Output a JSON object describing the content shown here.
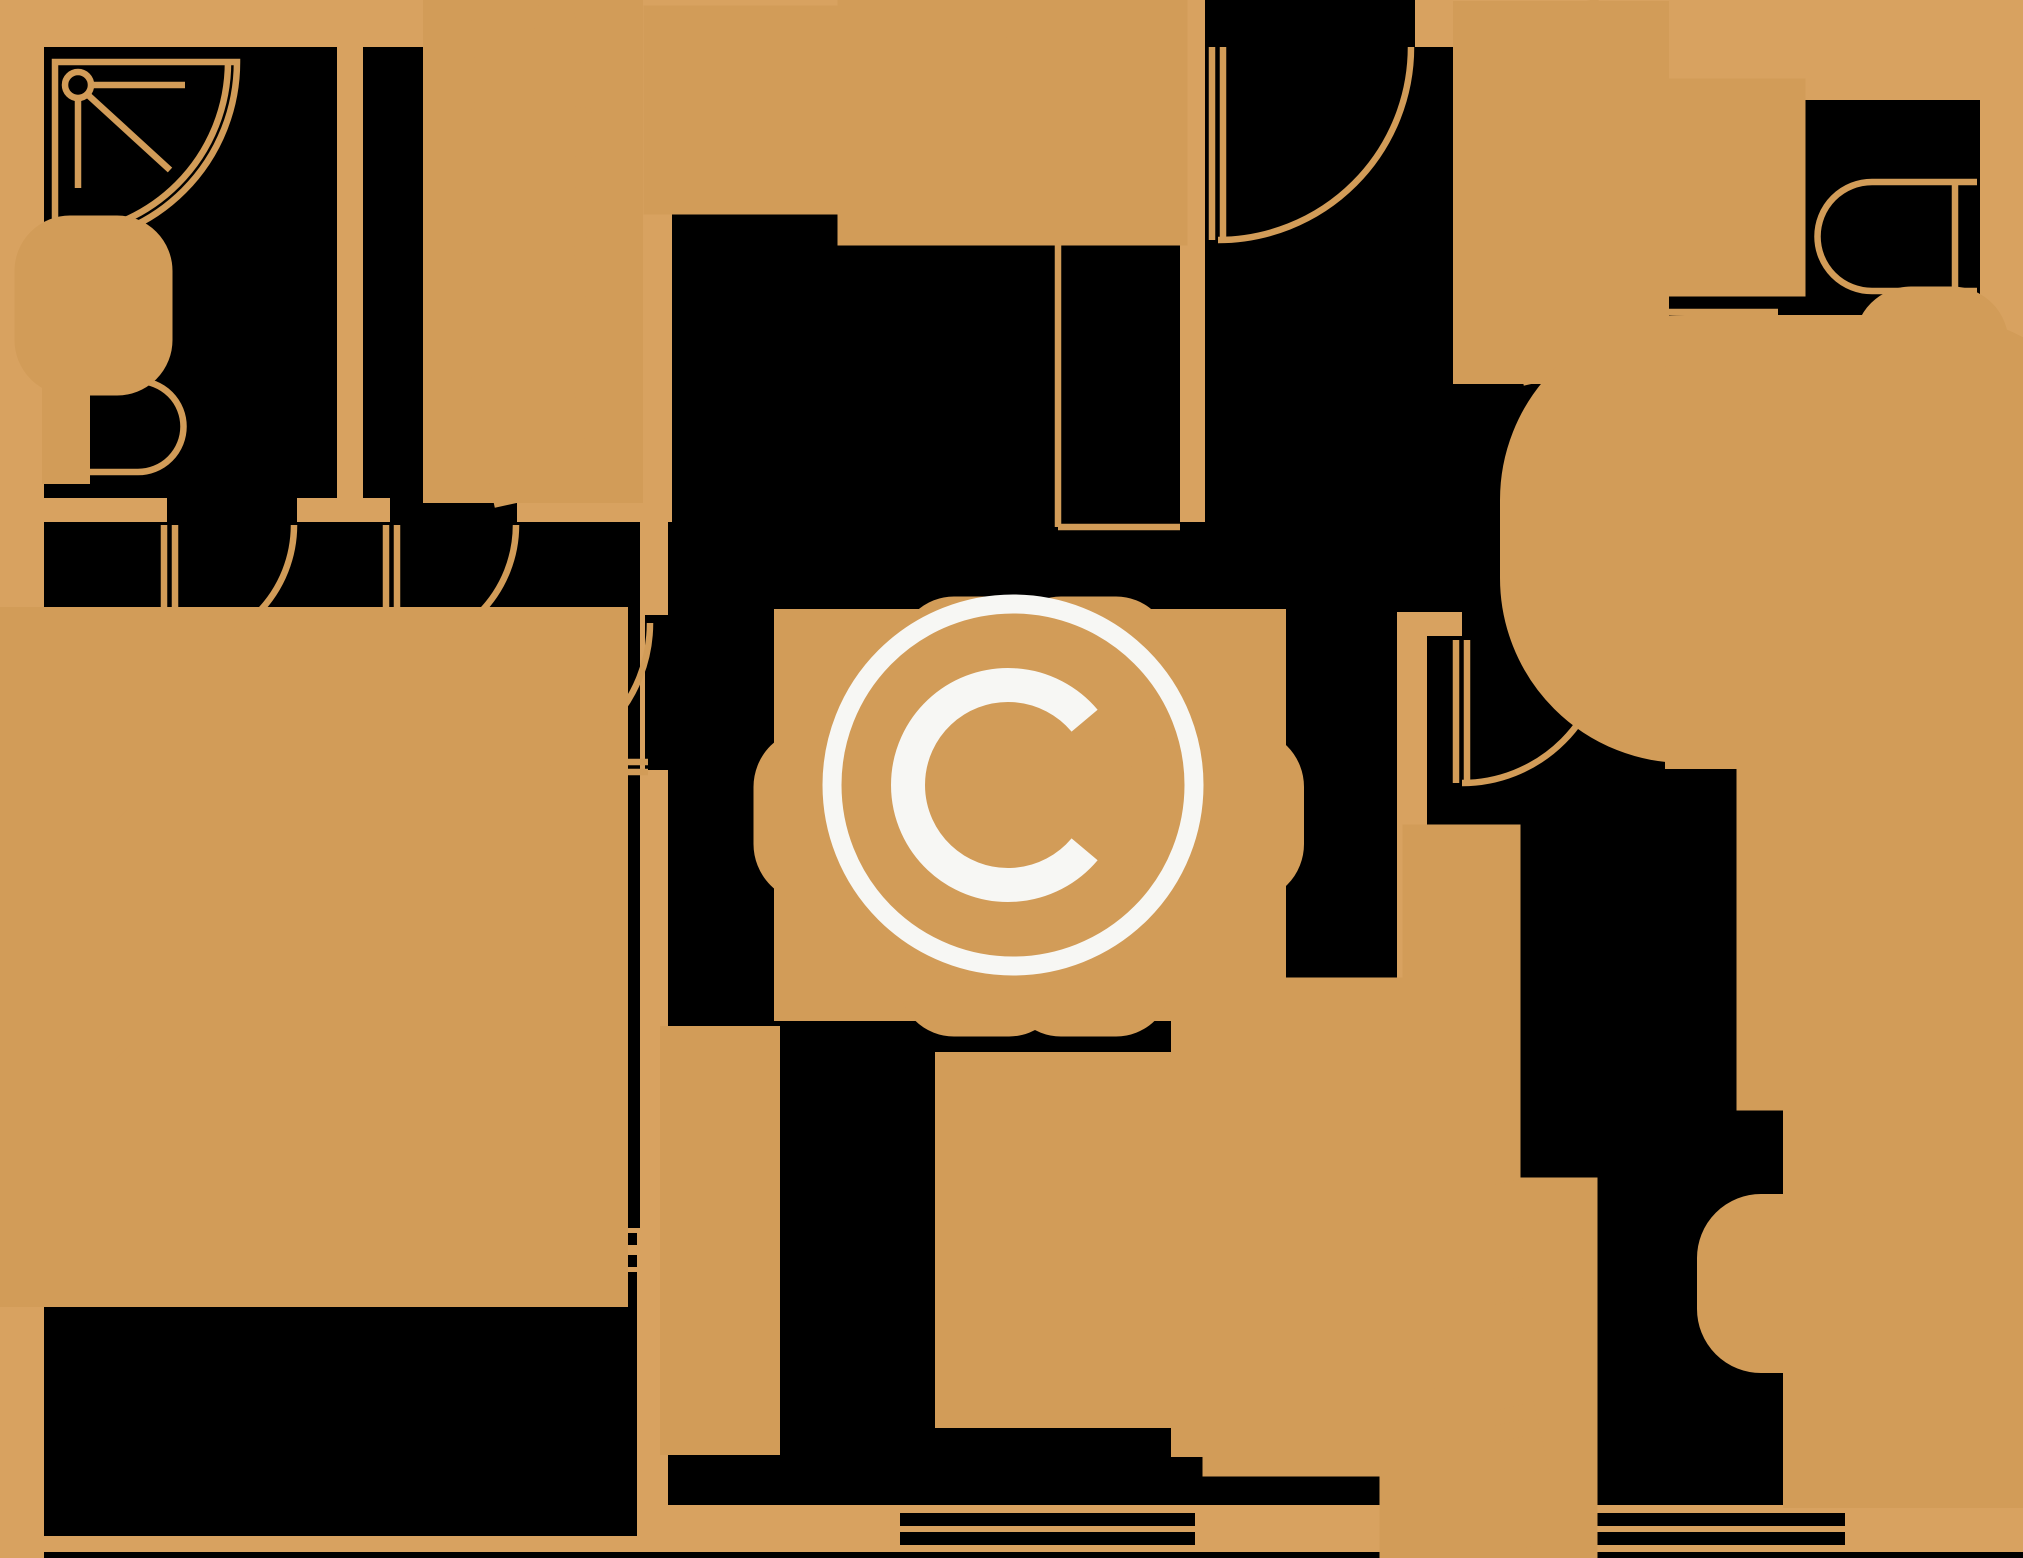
{
  "canvas": {
    "w": 2023,
    "h": 1558
  },
  "palette": {
    "wall": "#D8A260",
    "room": "#000000",
    "line": "#D29C58",
    "mark": "#F7F7F4"
  },
  "watermark": {
    "glyph": "copyright-symbol",
    "cx": 1013,
    "cy": 785,
    "ring_r": 181,
    "ring_w": 19,
    "c_path": "M1084.6,720.7 A100,100 0 1 0 1084.6,849.3",
    "c_w": 34
  },
  "rooms": [
    {
      "n": "room-bathroom-topleft",
      "x": 44,
      "y": 47,
      "w": 293,
      "h": 451
    },
    {
      "n": "room-closet-topleft",
      "x": 363,
      "y": 47,
      "w": 227,
      "h": 451
    },
    {
      "n": "room-kitchen",
      "x": 672,
      "y": 47,
      "w": 508,
      "h": 480
    },
    {
      "n": "room-hall",
      "x": 1205,
      "y": 47,
      "w": 412,
      "h": 565
    },
    {
      "n": "entry-opening",
      "x": 1205,
      "y": 0,
      "w": 210,
      "h": 47
    },
    {
      "n": "room-bathroom-topright",
      "x": 1643,
      "y": 100,
      "w": 337,
      "h": 508
    },
    {
      "n": "doorway-bathroom-topright",
      "x": 1617,
      "y": 317,
      "w": 26,
      "h": 140
    },
    {
      "n": "room-bedroom-right",
      "x": 1427,
      "y": 636,
      "w": 553,
      "h": 869
    },
    {
      "n": "doorway-bedroom-right",
      "x": 1462,
      "y": 608,
      "w": 145,
      "h": 30
    },
    {
      "n": "room-living-dining",
      "x": 668,
      "y": 522,
      "w": 729,
      "h": 983
    },
    {
      "n": "room-bedroom-left",
      "x": 44,
      "y": 522,
      "w": 596,
      "h": 706
    },
    {
      "n": "doorway-bathroom-topleft",
      "x": 167,
      "y": 498,
      "w": 130,
      "h": 24
    },
    {
      "n": "doorway-closet",
      "x": 390,
      "y": 498,
      "w": 127,
      "h": 24
    },
    {
      "n": "doorway-living",
      "x": 645,
      "y": 615,
      "w": 25,
      "h": 155
    },
    {
      "n": "room-balcony",
      "x": 44,
      "y": 1272,
      "w": 593,
      "h": 264
    },
    {
      "n": "plan-bottom-edge",
      "x": 44,
      "y": 1552,
      "w": 1979,
      "h": 6
    },
    {
      "n": "window-bedroom-left-1",
      "x": 247,
      "y": 1233,
      "w": 390,
      "h": 12
    },
    {
      "n": "window-bedroom-left-2",
      "x": 247,
      "y": 1255,
      "w": 390,
      "h": 12
    },
    {
      "n": "window-living-1",
      "x": 900,
      "y": 1513,
      "w": 295,
      "h": 13
    },
    {
      "n": "window-living-2",
      "x": 900,
      "y": 1532,
      "w": 295,
      "h": 13
    },
    {
      "n": "window-bedroom-right-1",
      "x": 1554,
      "y": 1513,
      "w": 291,
      "h": 13
    },
    {
      "n": "window-bedroom-right-2",
      "x": 1554,
      "y": 1532,
      "w": 291,
      "h": 13
    }
  ],
  "shapes": [
    {
      "n": "shower-outline",
      "t": "path",
      "d": "M55,62 H237 A182,182 0 0 1 55,244 Z"
    },
    {
      "n": "shower-inner-arc",
      "t": "path",
      "d": "M228,62 A173,173 0 0 1 55,235"
    },
    {
      "n": "shower-head-icon",
      "t": "circle",
      "cx": 78,
      "cy": 85,
      "r": 13
    },
    {
      "n": "shower-arm",
      "t": "line",
      "x1": 91,
      "y1": 85,
      "x2": 185,
      "y2": 85
    },
    {
      "n": "shower-rail",
      "t": "line",
      "x1": 78,
      "y1": 98,
      "x2": 78,
      "y2": 188
    },
    {
      "n": "shower-hose",
      "t": "line",
      "x1": 88,
      "y1": 95,
      "x2": 170,
      "y2": 170
    },
    {
      "n": "sink-topleft",
      "t": "rrect",
      "x": 54,
      "y": 255,
      "w": 79,
      "h": 101,
      "rx": 16
    },
    {
      "n": "sink-topleft-basin",
      "t": "ellipse",
      "cx": 96,
      "cy": 306,
      "rx": 27,
      "ry": 39
    },
    {
      "n": "toilet-topleft-tank",
      "t": "rect",
      "x": 54,
      "y": 381,
      "w": 24,
      "h": 91
    },
    {
      "n": "toilet-topleft-bowl",
      "t": "path",
      "d": "M78,381 H138 A45.5,45.5 0 0 1 138,472 H78 Z"
    },
    {
      "n": "wardrobe-closet",
      "t": "hatch",
      "x": 478,
      "y": 55,
      "w": 110,
      "h": 393,
      "dividers": [
        160,
        415
      ],
      "groups": [
        [
          63,
          152,
          5
        ],
        [
          170,
          296,
          5
        ],
        [
          305,
          405,
          5
        ],
        [
          420,
          443,
          2
        ]
      ]
    },
    {
      "n": "counter-front-edge",
      "t": "line",
      "x1": 672,
      "y1": 170,
      "x2": 1058,
      "y2": 170
    },
    {
      "n": "counter-side-edge",
      "t": "line",
      "x1": 1058,
      "y1": 170,
      "x2": 1058,
      "y2": 527
    },
    {
      "n": "counter-end-edge",
      "t": "line",
      "x1": 1058,
      "y1": 527,
      "x2": 1180,
      "y2": 527
    },
    {
      "n": "stove",
      "t": "rect",
      "x": 695,
      "y": 57,
      "w": 103,
      "h": 106
    },
    {
      "n": "burner-icon-1",
      "t": "circle",
      "cx": 724,
      "cy": 85,
      "r": 15
    },
    {
      "n": "burner-icon-2",
      "t": "circle",
      "cx": 768,
      "cy": 85,
      "r": 15
    },
    {
      "n": "burner-icon-3",
      "t": "circle",
      "cx": 724,
      "cy": 138,
      "r": 15
    },
    {
      "n": "burner-icon-4",
      "t": "circle",
      "cx": 768,
      "cy": 138,
      "r": 15
    },
    {
      "n": "kitchen-sink-unit",
      "t": "rect",
      "x": 925,
      "y": 57,
      "w": 175,
      "h": 101
    },
    {
      "n": "kitchen-sink-drainer",
      "t": "rect",
      "x": 939,
      "y": 76,
      "w": 59,
      "h": 52
    },
    {
      "n": "kitchen-sink-basin",
      "t": "rrect",
      "x": 1011,
      "y": 71,
      "w": 75,
      "h": 68,
      "rx": 16
    },
    {
      "n": "kitchen-sink-outlet",
      "t": "rect",
      "x": 991,
      "y": 144,
      "w": 20,
      "h": 10
    },
    {
      "n": "dining-table",
      "t": "rect",
      "x": 902,
      "y": 737,
      "w": 256,
      "h": 156
    },
    {
      "n": "dining-chair-north-1",
      "t": "rrect",
      "x": 940,
      "y": 638,
      "w": 83,
      "h": 89,
      "rx": 14
    },
    {
      "n": "dining-chair-north-1-back",
      "t": "line",
      "x1": 944,
      "y1": 651,
      "x2": 1019,
      "y2": 651
    },
    {
      "n": "dining-chair-north-2",
      "t": "rrect",
      "x": 1047,
      "y": 638,
      "w": 83,
      "h": 89,
      "rx": 14
    },
    {
      "n": "dining-chair-north-2-back",
      "t": "line",
      "x1": 1051,
      "y1": 651,
      "x2": 1126,
      "y2": 651
    },
    {
      "n": "dining-chair-south-1",
      "t": "rrect",
      "x": 940,
      "y": 905,
      "w": 83,
      "h": 90,
      "rx": 14
    },
    {
      "n": "dining-chair-south-1-back",
      "t": "line",
      "x1": 944,
      "y1": 982,
      "x2": 1019,
      "y2": 982
    },
    {
      "n": "dining-chair-south-2",
      "t": "rrect",
      "x": 1047,
      "y": 905,
      "w": 83,
      "h": 90,
      "rx": 14
    },
    {
      "n": "dining-chair-south-2-back",
      "t": "line",
      "x1": 1051,
      "y1": 982,
      "x2": 1126,
      "y2": 982
    },
    {
      "n": "dining-chair-west",
      "t": "rrect",
      "x": 798,
      "y": 773,
      "w": 89,
      "h": 85,
      "rx": 14
    },
    {
      "n": "dining-chair-west-back",
      "t": "line",
      "x1": 811,
      "y1": 777,
      "x2": 811,
      "y2": 854
    },
    {
      "n": "dining-chair-east",
      "t": "rrect",
      "x": 1172,
      "y": 773,
      "w": 88,
      "h": 85,
      "rx": 14
    },
    {
      "n": "dining-chair-east-back",
      "t": "line",
      "x1": 1247,
      "y1": 777,
      "x2": 1247,
      "y2": 854
    },
    {
      "n": "tv-stand",
      "t": "rect",
      "x": 690,
      "y": 1056,
      "w": 60,
      "h": 369
    },
    {
      "n": "tv",
      "t": "rect",
      "x": 701,
      "y": 1097,
      "w": 14,
      "h": 280
    },
    {
      "n": "coffee-table",
      "t": "rect",
      "x": 1010,
      "y": 1127,
      "w": 150,
      "h": 226
    },
    {
      "n": "sofa-back",
      "t": "rect",
      "x": 1354,
      "y": 1028,
      "w": 41,
      "h": 398
    },
    {
      "n": "sofa-armrest-north",
      "t": "rect",
      "x": 1253,
      "y": 1028,
      "w": 101,
      "h": 30
    },
    {
      "n": "sofa-armrest-south",
      "t": "rect",
      "x": 1253,
      "y": 1396,
      "w": 101,
      "h": 30
    },
    {
      "n": "sofa-seat",
      "t": "rect",
      "x": 1232,
      "y": 1058,
      "w": 122,
      "h": 338
    },
    {
      "n": "sofa-cushion-split",
      "t": "line",
      "x1": 1232,
      "y1": 1227,
      "x2": 1354,
      "y2": 1227
    },
    {
      "n": "nightstand-left-1",
      "t": "rect",
      "x": 52,
      "y": 712,
      "w": 78,
      "h": 78
    },
    {
      "n": "bed-double",
      "t": "rect",
      "x": 55,
      "y": 798,
      "w": 382,
      "h": 318
    },
    {
      "n": "pillow-1",
      "t": "rect",
      "x": 58,
      "y": 802,
      "w": 72,
      "h": 72
    },
    {
      "n": "pillow-1-fold",
      "t": "line",
      "x1": 58,
      "y1": 874,
      "x2": 130,
      "y2": 802
    },
    {
      "n": "pillow-2",
      "t": "rect",
      "x": 58,
      "y": 1040,
      "w": 72,
      "h": 72
    },
    {
      "n": "pillow-2-fold",
      "t": "line",
      "x1": 58,
      "y1": 1112,
      "x2": 130,
      "y2": 1040
    },
    {
      "n": "nightstand-left-2",
      "t": "rect",
      "x": 49,
      "y": 1125,
      "w": 66,
      "h": 76
    },
    {
      "n": "wardrobe-hall",
      "t": "hatch",
      "x": 1507,
      "y": 55,
      "w": 108,
      "h": 275,
      "dividers": [
        170,
        240
      ],
      "groups": [
        [
          62,
          160,
          4
        ],
        [
          178,
          232,
          3
        ],
        [
          248,
          322,
          3
        ]
      ]
    },
    {
      "n": "washing-machine",
      "t": "rect",
      "x": 1657,
      "y": 128,
      "w": 99,
      "h": 119
    },
    {
      "n": "toilet-topright-bowl",
      "t": "path",
      "d": "M1977,182 H1872 A54.5,54.5 0 0 0 1872,291 H1977"
    },
    {
      "n": "toilet-topright-tank",
      "t": "line",
      "x1": 1955,
      "y1": 182,
      "x2": 1955,
      "y2": 291
    },
    {
      "n": "sink-topright",
      "t": "rrect",
      "x": 1893,
      "y": 325,
      "w": 77,
      "h": 97,
      "rx": 18
    },
    {
      "n": "sink-topright-basin",
      "t": "ellipse",
      "cx": 1927,
      "cy": 373,
      "rx": 25,
      "ry": 37
    },
    {
      "n": "bathtub",
      "t": "rrect",
      "x": 1655,
      "y": 470,
      "w": 310,
      "h": 138,
      "rx": 30
    },
    {
      "n": "bathtub-inner",
      "t": "rrect",
      "x": 1682,
      "y": 490,
      "w": 258,
      "h": 98,
      "rx": 24
    },
    {
      "n": "nightstand-right",
      "t": "rect",
      "x": 1705,
      "y": 650,
      "w": 80,
      "h": 79
    },
    {
      "n": "bed-single",
      "t": "rect",
      "x": 1812,
      "y": 650,
      "w": 151,
      "h": 385
    },
    {
      "n": "pillow-3",
      "t": "rect",
      "x": 1812,
      "y": 650,
      "w": 70,
      "h": 78
    },
    {
      "n": "pillow-3-fold",
      "t": "line",
      "x1": 1812,
      "y1": 728,
      "x2": 1882,
      "y2": 650
    },
    {
      "n": "cabinet-tall",
      "t": "rect",
      "x": 1432,
      "y": 854,
      "w": 59,
      "h": 346
    },
    {
      "n": "cabinet-tall-inner",
      "t": "rect",
      "x": 1443,
      "y": 895,
      "w": 15,
      "h": 250
    },
    {
      "n": "wardrobe-bedroom-right",
      "t": "hatch",
      "x": 1434,
      "y": 1232,
      "w": 109,
      "h": 273,
      "dividers": [
        1352,
        1477
      ],
      "groups": [
        [
          1242,
          1340,
          4
        ],
        [
          1362,
          1468,
          4
        ],
        [
          1483,
          1500,
          2
        ]
      ]
    },
    {
      "n": "desk",
      "t": "rect",
      "x": 1843,
      "y": 1138,
      "w": 120,
      "h": 310
    },
    {
      "n": "desk-chair",
      "t": "rrect",
      "x": 1743,
      "y": 1240,
      "w": 92,
      "h": 87,
      "rx": 18
    },
    {
      "n": "desk-chair-back",
      "t": "line",
      "x1": 1757,
      "y1": 1244,
      "x2": 1757,
      "y2": 1323
    },
    {
      "n": "door-bathroom-topleft-leaf-a",
      "t": "line",
      "x1": 164,
      "y1": 525,
      "x2": 164,
      "y2": 650
    },
    {
      "n": "door-bathroom-topleft-leaf-b",
      "t": "line",
      "x1": 175,
      "y1": 525,
      "x2": 175,
      "y2": 650
    },
    {
      "n": "door-bathroom-topleft-swing",
      "t": "path",
      "d": "M169,650 A125,125 0 0 0 294,525"
    },
    {
      "n": "door-closet-leaf-a",
      "t": "line",
      "x1": 386,
      "y1": 525,
      "x2": 386,
      "y2": 650
    },
    {
      "n": "door-closet-leaf-b",
      "t": "line",
      "x1": 397,
      "y1": 525,
      "x2": 397,
      "y2": 650
    },
    {
      "n": "door-closet-swing",
      "t": "path",
      "d": "M391,650 A125,125 0 0 0 516,525"
    },
    {
      "n": "door-living-leaf-a",
      "t": "line",
      "x1": 503,
      "y1": 762,
      "x2": 648,
      "y2": 762
    },
    {
      "n": "door-living-leaf-b",
      "t": "line",
      "x1": 503,
      "y1": 772,
      "x2": 648,
      "y2": 772
    },
    {
      "n": "door-living-swing",
      "t": "path",
      "d": "M503,770 A147,147 0 0 0 650,623"
    },
    {
      "n": "door-entry-leaf-a",
      "t": "line",
      "x1": 1212,
      "y1": 47,
      "x2": 1212,
      "y2": 240
    },
    {
      "n": "door-entry-leaf-b",
      "t": "line",
      "x1": 1223,
      "y1": 47,
      "x2": 1223,
      "y2": 240
    },
    {
      "n": "door-entry-swing",
      "t": "path",
      "d": "M1218,240 A193,193 0 0 0 1411,47"
    },
    {
      "n": "door-bathroom-topright-leaf-a",
      "t": "line",
      "x1": 1643,
      "y1": 312,
      "x2": 1778,
      "y2": 312
    },
    {
      "n": "door-bathroom-topright-leaf-b",
      "t": "line",
      "x1": 1643,
      "y1": 321,
      "x2": 1778,
      "y2": 321
    },
    {
      "n": "door-bathroom-topright-swing",
      "t": "path",
      "d": "M1778,318 A135,135 0 0 1 1643,453"
    },
    {
      "n": "door-bedroom-right-leaf-a",
      "t": "line",
      "x1": 1456,
      "y1": 640,
      "x2": 1456,
      "y2": 783
    },
    {
      "n": "door-bedroom-right-leaf-b",
      "t": "line",
      "x1": 1467,
      "y1": 640,
      "x2": 1467,
      "y2": 783
    },
    {
      "n": "door-bedroom-right-swing",
      "t": "path",
      "d": "M1462,783 A143,143 0 0 0 1605,640"
    }
  ]
}
